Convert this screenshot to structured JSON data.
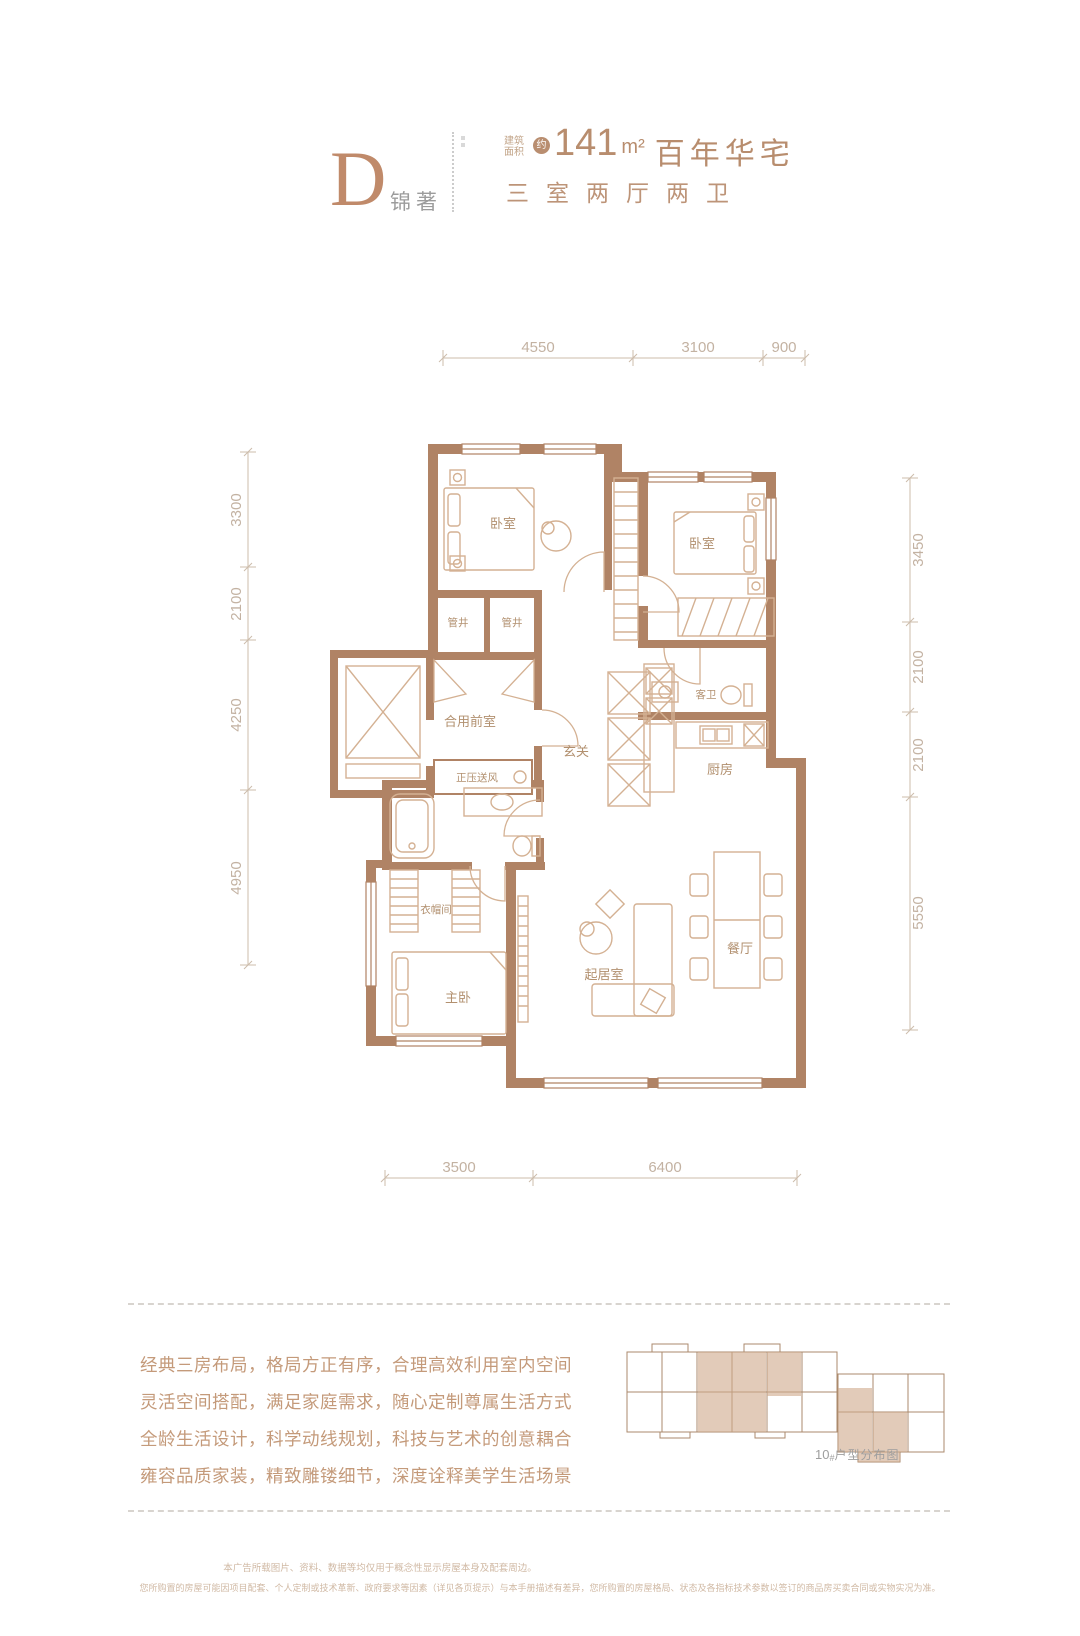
{
  "header": {
    "plan_letter": "D",
    "plan_name": "锦著",
    "area_label_line1": "建筑",
    "area_label_line2": "面积",
    "approx_badge": "约",
    "area_number": "141",
    "area_unit": "m²",
    "area_title": "百年华宅",
    "layout_line": "三室两厅两卫"
  },
  "floorplan": {
    "dimensions": {
      "top": [
        "4550",
        "3100",
        "900"
      ],
      "left": [
        "3300",
        "2100",
        "4250",
        "4950"
      ],
      "right": [
        "3450",
        "2100",
        "2100",
        "5550"
      ],
      "bottom": [
        "3500",
        "6400"
      ]
    },
    "rooms": [
      {
        "label": "卧室"
      },
      {
        "label": "卧室"
      },
      {
        "label": "管井"
      },
      {
        "label": "管井"
      },
      {
        "label": "合用前室"
      },
      {
        "label": "玄关"
      },
      {
        "label": "客卫"
      },
      {
        "label": "厨房"
      },
      {
        "label": "正压送风"
      },
      {
        "label": "衣帽间"
      },
      {
        "label": "主卧"
      },
      {
        "label": "起居室"
      },
      {
        "label": "餐厅"
      }
    ]
  },
  "description": {
    "lines": [
      "经典三房布局，格局方正有序，合理高效利用室内空间",
      "灵活空间搭配，满足家庭需求，随心定制尊属生活方式",
      "全龄生活设计，科学动线规划，科技与艺术的创意耦合",
      "雍容品质家装，精致雕镂细节，深度诠释美学生活场景"
    ]
  },
  "keyplan": {
    "caption_number": "10",
    "caption_hash": "#",
    "caption_label": "户型分布图"
  },
  "disclaimer": {
    "line1": "本广告所载图片、资料、数据等均仅用于概念性显示房屋本身及配套周边。",
    "line2": "您所购置的房屋可能因项目配套、个人定制或技术革新、政府要求等因素（详见各页提示）与本手册描述有差异，您所购置的房屋格局、状态及各指标技术参数以签订的商品房买卖合同或实物实况为准。"
  },
  "colors": {
    "wall": "#b08365",
    "accent": "#b88d6e",
    "furniture": "#d4b193",
    "dim_text": "#c3b2a2",
    "desc_text": "#c49a7a",
    "highlight": "#cfa98b"
  }
}
